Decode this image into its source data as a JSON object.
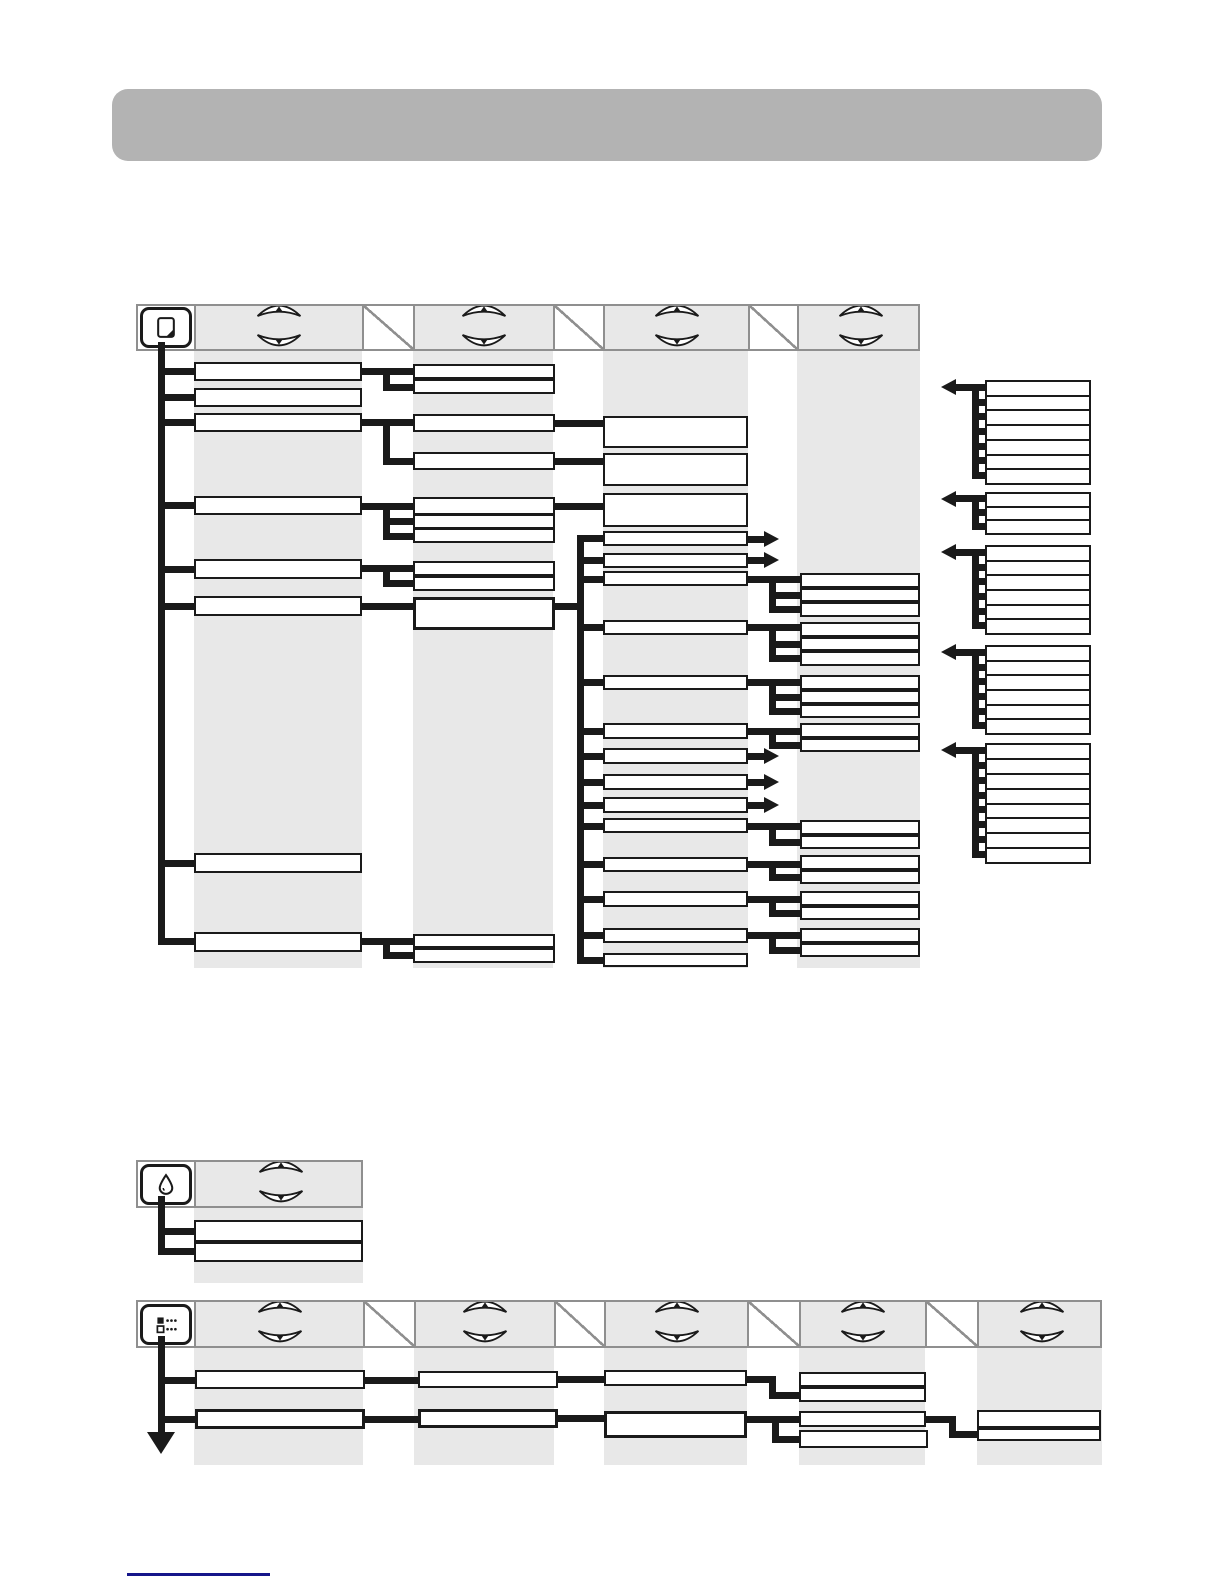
{
  "page": {
    "kind": "printer-control-panel-menu-map",
    "canvas": {
      "width": 1224,
      "height": 1584,
      "background": "#ffffff"
    },
    "colors": {
      "line": "#1a1a1a",
      "box_border": "#1a1a1a",
      "box_fill": "#ffffff",
      "band": "#e8e8e8",
      "header_fill": "#e8e8e8",
      "header_border": "#8f8f8f",
      "banner": "#b3b3b3",
      "footer_rule": "#15158a"
    },
    "banner": {
      "x": 112,
      "y": 89,
      "w": 990,
      "h": 72,
      "radius": 16
    },
    "footer_rule": {
      "x": 127,
      "y": 1573,
      "w": 143,
      "h": 3
    }
  },
  "icons": {
    "panel1": "paper-icon",
    "panel2": "ink-drop-icon",
    "panel3": "menu-list-icon",
    "scroll_up": "up-arrow-button-icon",
    "scroll_down": "down-arrow-button-icon"
  },
  "panels": [
    {
      "name": "paper-menu-panel",
      "icon": "paper-icon",
      "header": {
        "x": 136,
        "y": 304,
        "h": 47,
        "cells": [
          [
            "icon",
            58
          ],
          [
            "arrows",
            168
          ],
          [
            "slash",
            51
          ],
          [
            "arrows",
            140
          ],
          [
            "slash",
            50
          ],
          [
            "arrows",
            145
          ],
          [
            "slash",
            49
          ],
          [
            "arrows",
            123
          ]
        ]
      },
      "bands": [
        [
          194,
          351,
          168,
          617
        ],
        [
          413,
          351,
          140,
          617
        ],
        [
          603,
          351,
          145,
          617
        ],
        [
          797,
          351,
          123,
          617
        ]
      ],
      "boxes": [
        [
          194,
          362,
          168,
          19
        ],
        [
          194,
          388,
          168,
          19
        ],
        [
          194,
          413,
          168,
          19
        ],
        [
          194,
          496,
          168,
          19
        ],
        [
          194,
          559,
          168,
          20
        ],
        [
          194,
          596,
          168,
          20
        ],
        [
          194,
          853,
          168,
          20
        ],
        [
          194,
          932,
          168,
          20
        ],
        [
          413,
          364,
          142,
          15
        ],
        [
          413,
          379,
          142,
          15
        ],
        [
          413,
          414,
          142,
          18
        ],
        [
          413,
          452,
          142,
          18
        ],
        [
          413,
          497,
          142,
          18
        ],
        [
          413,
          514,
          142,
          15
        ],
        [
          413,
          528,
          142,
          15
        ],
        [
          413,
          561,
          142,
          15
        ],
        [
          413,
          576,
          142,
          15
        ],
        [
          413,
          597,
          142,
          33,
          1
        ],
        [
          413,
          934,
          142,
          14
        ],
        [
          413,
          948,
          142,
          15
        ],
        [
          603,
          416,
          145,
          32
        ],
        [
          603,
          453,
          145,
          33
        ],
        [
          603,
          493,
          145,
          34
        ],
        [
          603,
          531,
          145,
          15
        ],
        [
          603,
          553,
          145,
          15
        ],
        [
          603,
          571,
          145,
          15
        ],
        [
          603,
          620,
          145,
          15
        ],
        [
          603,
          675,
          145,
          15
        ],
        [
          603,
          723,
          145,
          16
        ],
        [
          603,
          748,
          145,
          16
        ],
        [
          603,
          774,
          145,
          16
        ],
        [
          603,
          797,
          145,
          16
        ],
        [
          603,
          818,
          145,
          15
        ],
        [
          603,
          857,
          145,
          15
        ],
        [
          603,
          891,
          145,
          16
        ],
        [
          603,
          928,
          145,
          15
        ],
        [
          603,
          953,
          145,
          14
        ],
        [
          800,
          573,
          120,
          15
        ],
        [
          800,
          588,
          120,
          14
        ],
        [
          800,
          602,
          120,
          15
        ],
        [
          800,
          622,
          120,
          15
        ],
        [
          800,
          637,
          120,
          14
        ],
        [
          800,
          651,
          120,
          15
        ],
        [
          800,
          675,
          120,
          15
        ],
        [
          800,
          690,
          120,
          14
        ],
        [
          800,
          704,
          120,
          14
        ],
        [
          800,
          723,
          120,
          15
        ],
        [
          800,
          738,
          120,
          14
        ],
        [
          800,
          820,
          120,
          15
        ],
        [
          800,
          835,
          120,
          14
        ],
        [
          800,
          855,
          120,
          15
        ],
        [
          800,
          870,
          120,
          14
        ],
        [
          800,
          891,
          120,
          15
        ],
        [
          800,
          906,
          120,
          14
        ],
        [
          800,
          928,
          120,
          15
        ],
        [
          800,
          943,
          120,
          14
        ]
      ],
      "segs": [
        [
          "v",
          161,
          342,
          603
        ],
        [
          "h",
          158,
          371,
          36
        ],
        [
          "h",
          158,
          397,
          36
        ],
        [
          "h",
          158,
          422,
          36
        ],
        [
          "h",
          158,
          505,
          36
        ],
        [
          "h",
          158,
          569,
          36
        ],
        [
          "h",
          158,
          606,
          36
        ],
        [
          "h",
          158,
          863,
          36
        ],
        [
          "h",
          158,
          941,
          36
        ],
        [
          "h",
          360,
          371,
          53
        ],
        [
          "v",
          386,
          368,
          22
        ],
        [
          "h",
          383,
          387,
          30
        ],
        [
          "h",
          360,
          422,
          53
        ],
        [
          "v",
          386,
          419,
          45
        ],
        [
          "h",
          383,
          461,
          30
        ],
        [
          "h",
          360,
          506,
          53
        ],
        [
          "v",
          386,
          503,
          36
        ],
        [
          "h",
          383,
          521,
          30
        ],
        [
          "h",
          383,
          536,
          30
        ],
        [
          "h",
          360,
          568,
          53
        ],
        [
          "v",
          386,
          565,
          21
        ],
        [
          "h",
          383,
          583,
          30
        ],
        [
          "h",
          360,
          606,
          53
        ],
        [
          "h",
          360,
          941,
          53
        ],
        [
          "v",
          386,
          938,
          20
        ],
        [
          "h",
          383,
          955,
          30
        ],
        [
          "h",
          553,
          423,
          50
        ],
        [
          "h",
          553,
          461,
          50
        ],
        [
          "h",
          553,
          506,
          50
        ],
        [
          "h",
          553,
          606,
          30
        ],
        [
          "v",
          580,
          535,
          428
        ],
        [
          "h",
          577,
          538,
          26
        ],
        [
          "h",
          577,
          560,
          26
        ],
        [
          "h",
          577,
          579,
          26
        ],
        [
          "h",
          577,
          627,
          26
        ],
        [
          "h",
          577,
          682,
          26
        ],
        [
          "h",
          577,
          731,
          26
        ],
        [
          "h",
          577,
          756,
          26
        ],
        [
          "h",
          577,
          782,
          26
        ],
        [
          "h",
          577,
          805,
          26
        ],
        [
          "h",
          577,
          826,
          26
        ],
        [
          "h",
          577,
          864,
          26
        ],
        [
          "h",
          577,
          899,
          26
        ],
        [
          "h",
          577,
          935,
          26
        ],
        [
          "h",
          577,
          960,
          26
        ],
        [
          "h",
          746,
          579,
          54
        ],
        [
          "v",
          772,
          576,
          36
        ],
        [
          "h",
          769,
          595,
          31
        ],
        [
          "h",
          769,
          609,
          31
        ],
        [
          "h",
          746,
          627,
          54
        ],
        [
          "v",
          772,
          624,
          37
        ],
        [
          "h",
          769,
          644,
          31
        ],
        [
          "h",
          769,
          658,
          31
        ],
        [
          "h",
          746,
          682,
          54
        ],
        [
          "v",
          772,
          679,
          35
        ],
        [
          "h",
          769,
          697,
          31
        ],
        [
          "h",
          769,
          711,
          31
        ],
        [
          "h",
          746,
          731,
          54
        ],
        [
          "v",
          772,
          728,
          20
        ],
        [
          "h",
          769,
          745,
          31
        ],
        [
          "h",
          746,
          826,
          54
        ],
        [
          "v",
          772,
          823,
          22
        ],
        [
          "h",
          769,
          842,
          31
        ],
        [
          "h",
          746,
          864,
          54
        ],
        [
          "v",
          772,
          861,
          19
        ],
        [
          "h",
          769,
          877,
          31
        ],
        [
          "h",
          746,
          899,
          54
        ],
        [
          "v",
          772,
          896,
          20
        ],
        [
          "h",
          769,
          913,
          31
        ],
        [
          "h",
          746,
          935,
          54
        ],
        [
          "v",
          772,
          932,
          21
        ],
        [
          "h",
          769,
          950,
          31
        ]
      ],
      "arrows_right": [
        [
          748,
          539
        ],
        [
          748,
          560
        ],
        [
          748,
          756
        ],
        [
          748,
          782
        ],
        [
          748,
          805
        ]
      ],
      "down_arrow": null
    },
    {
      "name": "ink-menu-panel",
      "icon": "ink-drop-icon",
      "header": {
        "x": 136,
        "y": 1160,
        "h": 48,
        "cells": [
          [
            "icon",
            58
          ],
          [
            "arrows",
            169
          ]
        ]
      },
      "bands": [
        [
          194,
          1208,
          169,
          75
        ]
      ],
      "boxes": [
        [
          194,
          1220,
          169,
          22
        ],
        [
          194,
          1242,
          169,
          20
        ]
      ],
      "segs": [
        [
          "v",
          161,
          1196,
          58
        ],
        [
          "h",
          158,
          1231,
          36
        ],
        [
          "h",
          158,
          1251,
          36
        ]
      ],
      "arrows_right": [],
      "down_arrow": null
    },
    {
      "name": "setup-menu-panel",
      "icon": "menu-list-icon",
      "header": {
        "x": 136,
        "y": 1300,
        "h": 48,
        "cells": [
          [
            "icon",
            58
          ],
          [
            "arrows",
            169
          ],
          [
            "slash",
            51
          ],
          [
            "arrows",
            140
          ],
          [
            "slash",
            50
          ],
          [
            "arrows",
            143
          ],
          [
            "slash",
            52
          ],
          [
            "arrows",
            126
          ],
          [
            "slash",
            52
          ],
          [
            "arrows",
            125
          ]
        ]
      },
      "bands": [
        [
          194,
          1348,
          169,
          117
        ],
        [
          414,
          1348,
          140,
          117
        ],
        [
          604,
          1348,
          143,
          117
        ],
        [
          799,
          1348,
          126,
          117
        ],
        [
          977,
          1348,
          125,
          117
        ]
      ],
      "boxes": [
        [
          195,
          1370,
          170,
          19
        ],
        [
          418,
          1371,
          140,
          17
        ],
        [
          604,
          1370,
          143,
          16
        ],
        [
          799,
          1372,
          127,
          15
        ],
        [
          799,
          1387,
          127,
          15
        ],
        [
          195,
          1409,
          170,
          20,
          1
        ],
        [
          418,
          1409,
          140,
          19,
          1
        ],
        [
          604,
          1411,
          143,
          27,
          1
        ],
        [
          799,
          1411,
          127,
          16
        ],
        [
          799,
          1430,
          129,
          18
        ],
        [
          977,
          1410,
          124,
          18
        ],
        [
          977,
          1428,
          124,
          13
        ]
      ],
      "segs": [
        [
          "v",
          161,
          1336,
          96
        ],
        [
          "h",
          158,
          1380,
          37
        ],
        [
          "h",
          158,
          1419,
          37
        ],
        [
          "h",
          365,
          1380,
          53
        ],
        [
          "h",
          558,
          1379,
          47
        ],
        [
          "h",
          747,
          1379,
          28
        ],
        [
          "v",
          772,
          1376,
          22
        ],
        [
          "h",
          769,
          1395,
          30
        ],
        [
          "h",
          365,
          1419,
          53
        ],
        [
          "h",
          558,
          1418,
          47
        ],
        [
          "h",
          747,
          1419,
          55
        ],
        [
          "v",
          775,
          1416,
          26
        ],
        [
          "h",
          772,
          1439,
          27
        ],
        [
          "h",
          926,
          1419,
          28
        ],
        [
          "v",
          952,
          1416,
          21
        ],
        [
          "h",
          949,
          1434,
          28
        ]
      ],
      "arrows_right": [],
      "down_arrow": [
        161,
        1432
      ]
    }
  ],
  "value_list_groups": {
    "x": 985,
    "w": 106,
    "spine_x": 975,
    "arrow_tip_x": 941,
    "groups": [
      {
        "top": 380,
        "bottom": 483,
        "rows": 7
      },
      {
        "top": 492,
        "bottom": 533,
        "rows": 3
      },
      {
        "top": 545,
        "bottom": 633,
        "rows": 6
      },
      {
        "top": 645,
        "bottom": 733,
        "rows": 6
      },
      {
        "top": 743,
        "bottom": 862,
        "rows": 8
      }
    ]
  }
}
